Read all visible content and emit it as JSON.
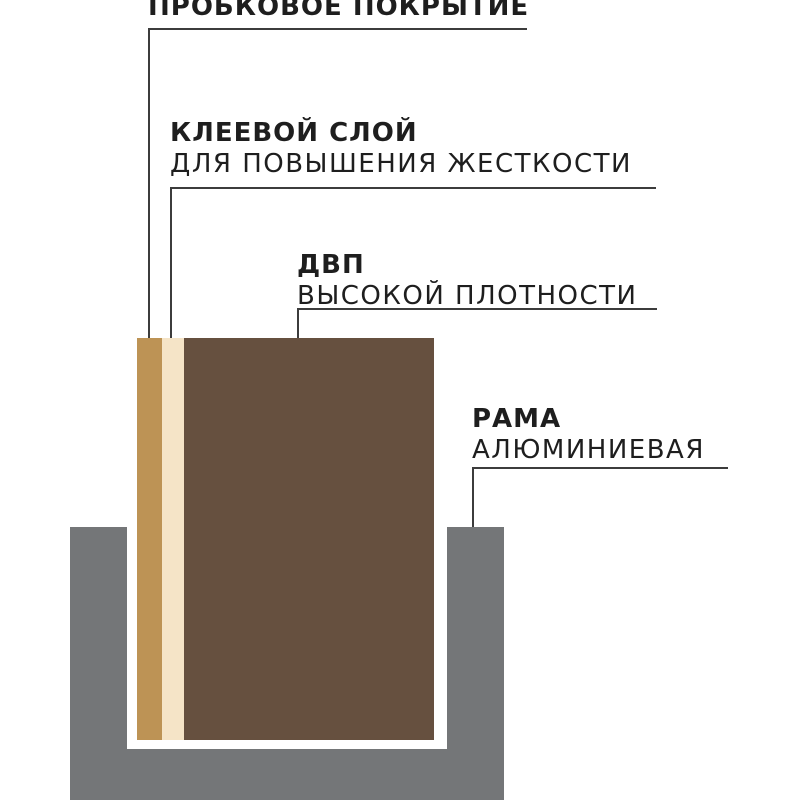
{
  "diagram": {
    "labels": [
      {
        "title": "ПРОБКОВОЕ ПОКРЫТИЕ",
        "subtitle": ""
      },
      {
        "title": "КЛЕЕВОЙ СЛОЙ",
        "subtitle": "ДЛЯ ПОВЫШЕНИЯ ЖЕСТКОСТИ"
      },
      {
        "title": "ДВП",
        "subtitle": "ВЫСОКОЙ ПЛОТНОСТИ"
      },
      {
        "title": "РАМА",
        "subtitle": "АЛЮМИНИЕВАЯ"
      }
    ],
    "colors": {
      "background": "#ffffff",
      "text": "#1e1e1e",
      "callout_line": "#3c3c3c",
      "cork": "#bd9355",
      "adhesive": "#f5e4c7",
      "hdf_board": "#66503f",
      "frame": "#747678"
    }
  }
}
